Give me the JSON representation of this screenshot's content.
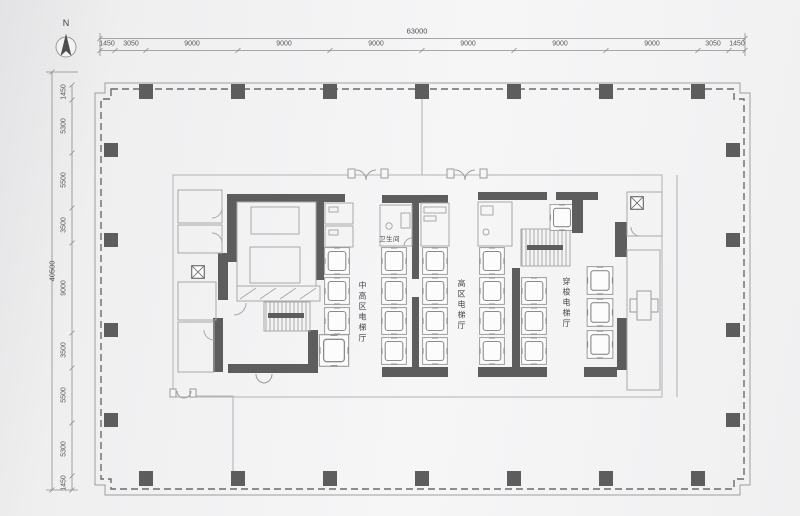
{
  "compass": {
    "label": "N"
  },
  "dimensions": {
    "top": {
      "total": "63000",
      "segments": [
        "1450",
        "3050",
        "9000",
        "9000",
        "9000",
        "9000",
        "9000",
        "9000",
        "3050",
        "1450"
      ]
    },
    "left": {
      "total": "40500",
      "segments": [
        "1450",
        "5300",
        "5500",
        "3500",
        "9000",
        "3500",
        "5500",
        "5300",
        "1450"
      ]
    }
  },
  "plan": {
    "labels": {
      "mid_high_hall": "中高区电梯厅",
      "high_hall": "高区电梯厅",
      "shuttle_hall": "穿梭电梯厅",
      "restroom": "卫生间"
    }
  },
  "colors": {
    "wall": "#5d5d5d",
    "thin_line": "#a8a8a8",
    "boundary_dash": "#6b6b6b",
    "background": "#f2f2f3",
    "text": "#585858"
  }
}
